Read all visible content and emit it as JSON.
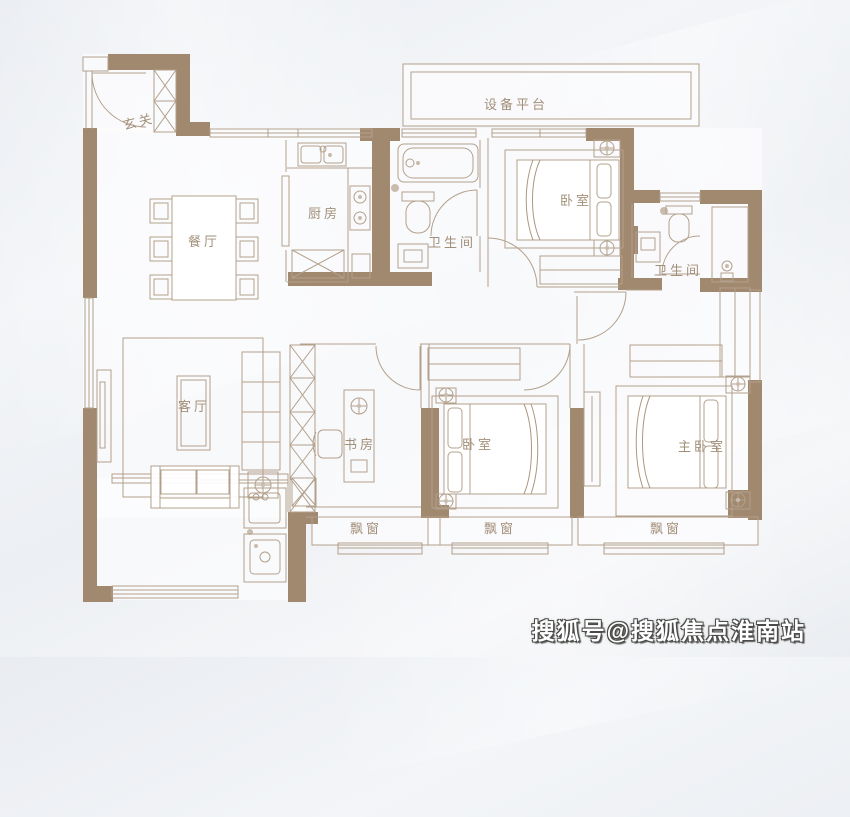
{
  "colors": {
    "wall": "#a1896f",
    "line": "#b3a08c",
    "label": "#a28f79",
    "background": "#edeff3",
    "watermark_fill": "#ffffff",
    "watermark_outline": "#4a4a48"
  },
  "rooms": {
    "entry": {
      "label": "玄关"
    },
    "dining": {
      "label": "餐厅"
    },
    "kitchen": {
      "label": "厨房"
    },
    "equipment_platform": {
      "label": "设备平台"
    },
    "bathroom_1": {
      "label": "卫生间"
    },
    "bathroom_2": {
      "label": "卫生间"
    },
    "bedroom_north": {
      "label": "卧室"
    },
    "bedroom_south": {
      "label": "卧室"
    },
    "master_bedroom": {
      "label": "主卧室"
    },
    "living_room": {
      "label": "客厅"
    },
    "study": {
      "label": "书房"
    },
    "bay_window_study": {
      "label": "飘窗"
    },
    "bay_window_bedroom": {
      "label": "飘窗"
    },
    "bay_window_master": {
      "label": "飘窗"
    }
  },
  "watermark": {
    "text": "搜狐号@搜狐焦点淮南站"
  }
}
